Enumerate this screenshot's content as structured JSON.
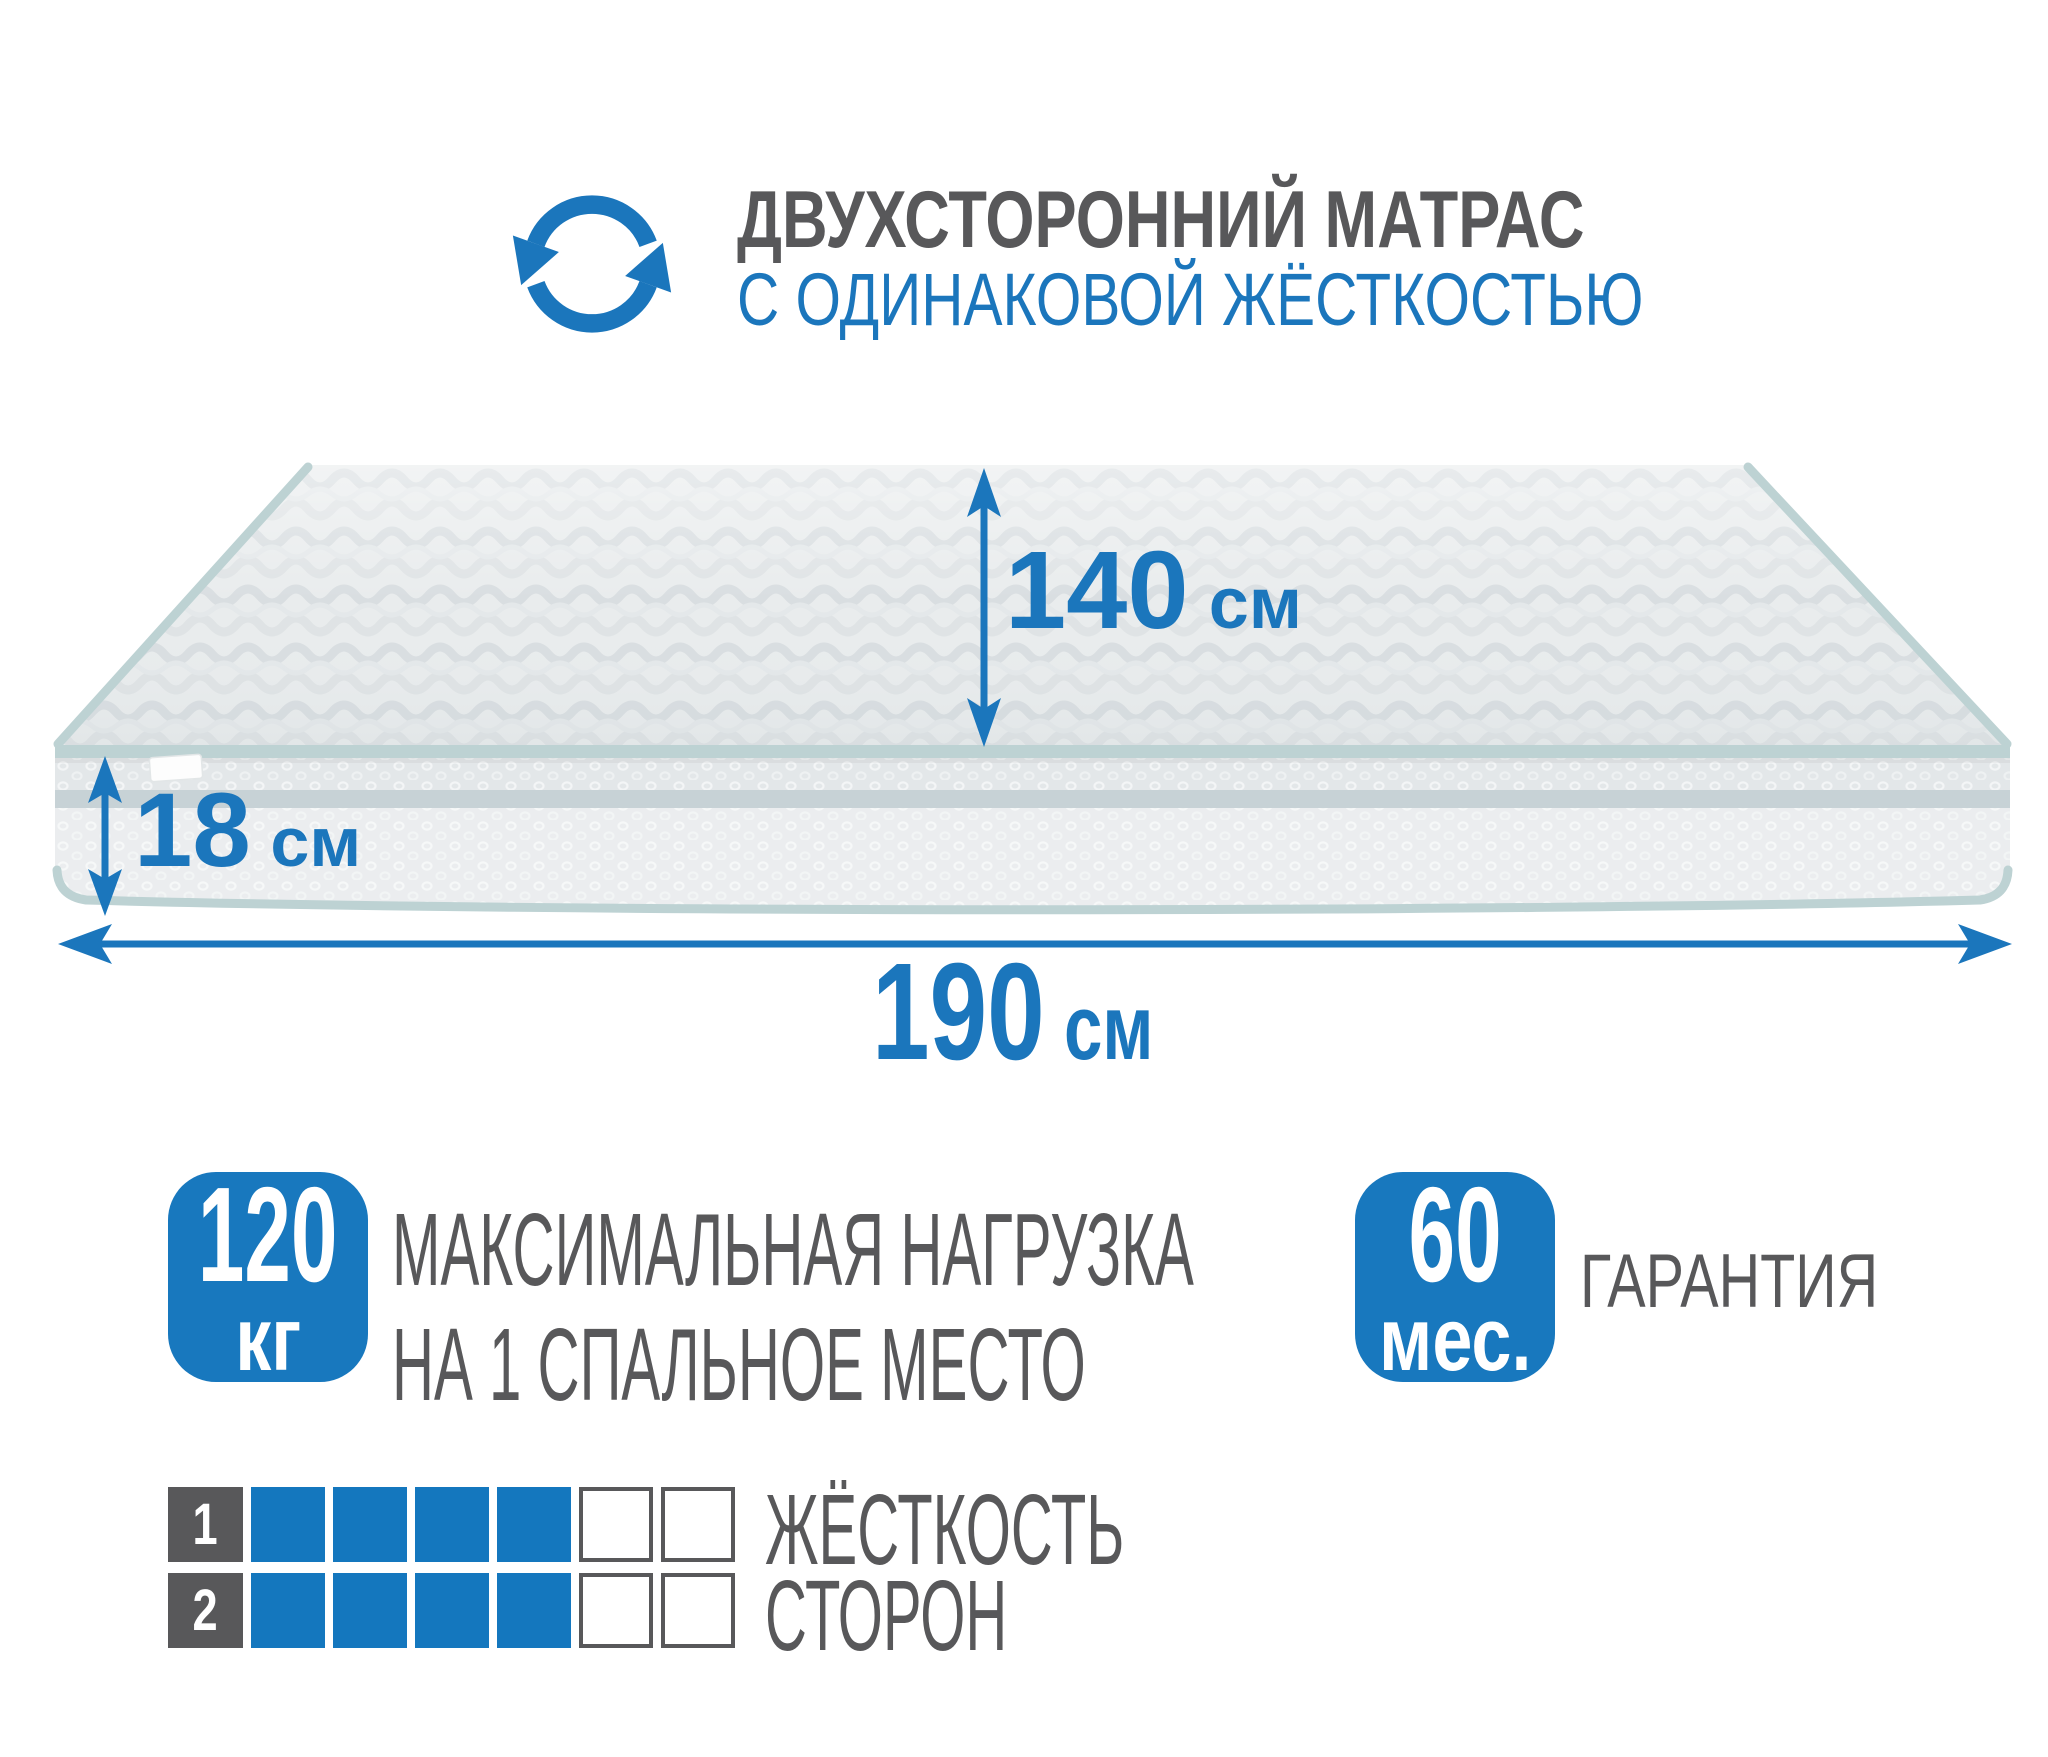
{
  "colors": {
    "accent_blue": "#1b76bc",
    "square_blue": "#1477be",
    "badge_blue": "#1878be",
    "dark_gray": "#58585a",
    "piping_teal": "#bdd2d3",
    "band_gray": "#c7d2d6",
    "fabric_top": "#e9eced",
    "fabric_side": "#e3e7e9"
  },
  "header": {
    "icon": "rotate-arrows-icon",
    "title_line1": "ДВУХСТОРОННИЙ МАТРАС",
    "title_line2": "С ОДИНАКОВОЙ ЖЁСТКОСТЬЮ"
  },
  "dimensions": {
    "depth_label": {
      "value": "140",
      "unit": "см"
    },
    "height_label": {
      "value": "18",
      "unit": "см"
    },
    "length_label": {
      "value": "190",
      "unit": "см"
    }
  },
  "features": {
    "max_load": {
      "badge_value": "120",
      "badge_unit": "кг",
      "label_line1": "МАКСИМАЛЬНАЯ НАГРУЗКА",
      "label_line2": "НА 1 СПАЛЬНОЕ МЕСТО"
    },
    "warranty": {
      "badge_value": "60",
      "badge_unit": "мес.",
      "label": "ГАРАНТИЯ"
    }
  },
  "firmness_scale": {
    "label_line1": "ЖЁСТКОСТЬ",
    "label_line2": "СТОРОН",
    "rows": [
      {
        "side": "1",
        "filled": 4,
        "total": 6
      },
      {
        "side": "2",
        "filled": 4,
        "total": 6
      }
    ]
  }
}
